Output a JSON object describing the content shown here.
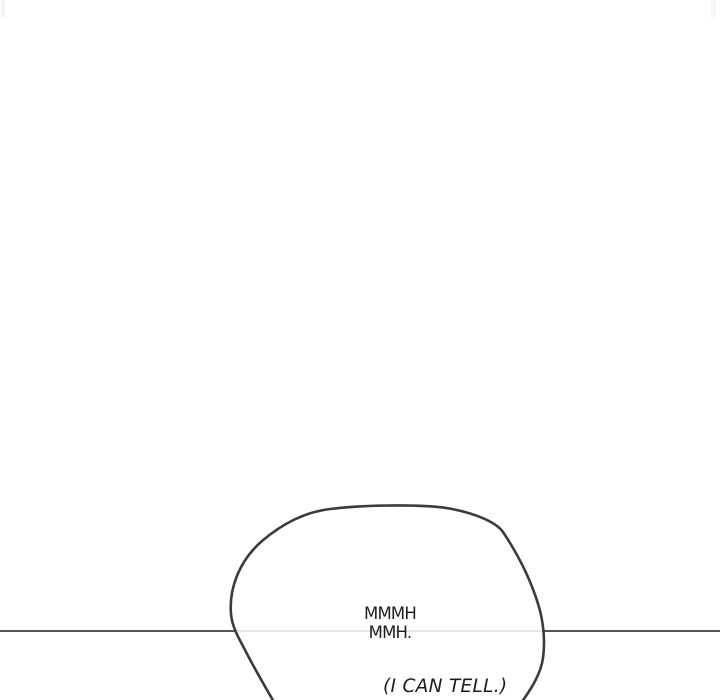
{
  "panel": {
    "background_color": "#ffffff",
    "divider_color": "#1f1f1f",
    "divider_y": "631",
    "seam_mark_color": "#f4f4f4"
  },
  "bubble": {
    "stroke_color": "#3b3b3b",
    "fill_color": "rgba(255,255,255,0.85)",
    "interior_divider_tint": "#dcdcdc",
    "line1": "MMMH",
    "line2": "MMH.",
    "caption": "(I CAN TELL.)",
    "text_color": "#1e1e1e"
  }
}
